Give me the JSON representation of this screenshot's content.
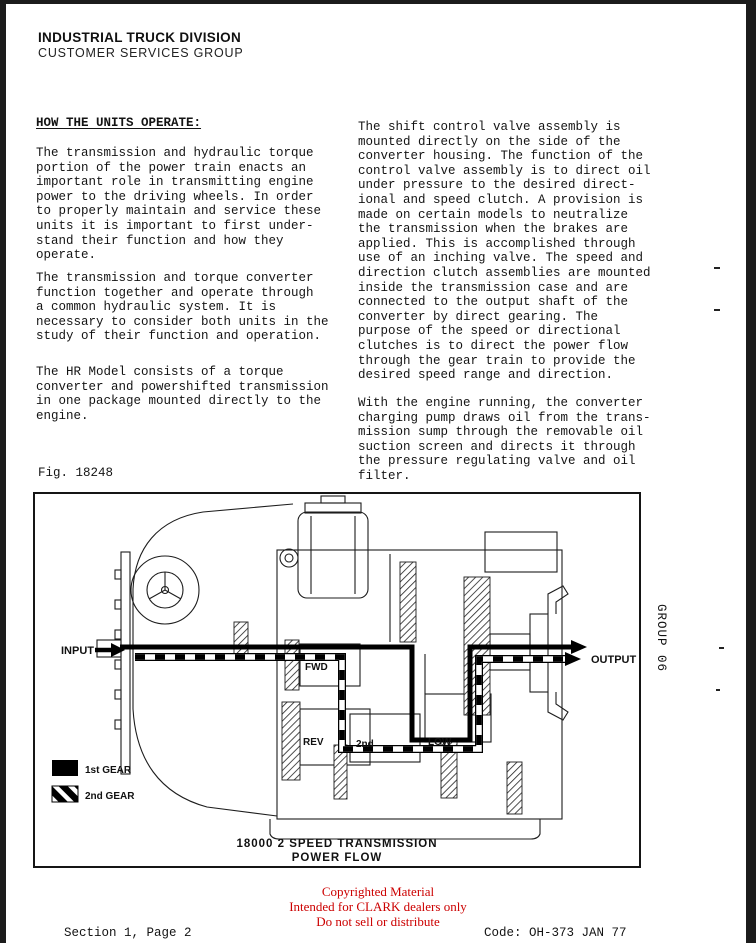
{
  "header": {
    "line1": "INDUSTRIAL TRUCK DIVISION",
    "line2": "CUSTOMER SERVICES GROUP"
  },
  "left_column": {
    "heading": "HOW THE UNITS OPERATE:",
    "p1": "The transmission and hydraulic torque\nportion of the power train enacts an\nimportant role in transmitting engine\npower to the driving wheels.  In order\nto properly maintain and service these\nunits it is important to first under-\nstand their function and how they\noperate.",
    "p2": "The transmission and torque converter\nfunction together and operate through\na common hydraulic system.  It is\nnecessary to consider both units in the\nstudy of their function and operation.",
    "p3": "The HR Model consists of a torque\nconverter and powershifted transmission\nin one package mounted directly to the\nengine.",
    "fig_label": "Fig. 18248"
  },
  "right_column": {
    "p1": "The shift control valve assembly is\nmounted directly on the side of the\nconverter housing.  The function of the\ncontrol valve assembly is to direct oil\nunder pressure to the desired direct-\nional and speed clutch.  A provision is\nmade on certain models to neutralize\nthe transmission when the brakes are\napplied.  This is accomplished through\nuse of an inching valve.  The speed and\ndirection clutch assemblies are mounted\ninside the transmission case and are\nconnected to the output shaft of the\nconverter by direct gearing.  The\npurpose of the speed or directional\nclutches is to direct the power flow\nthrough the gear train to provide the\ndesired speed range and direction.",
    "p2": "With the engine running, the converter\ncharging pump draws oil from the trans-\nmission sump through the removable oil\nsuction screen and directs it through\nthe pressure regulating valve and oil\nfilter."
  },
  "figure": {
    "labels": {
      "input": "INPUT",
      "output": "OUTPUT",
      "fwd": "FWD",
      "rev": "REV",
      "second": "2nd",
      "low": "LOW"
    },
    "legend": {
      "first_gear": "1st GEAR",
      "second_gear": "2nd GEAR"
    },
    "caption_line1": "18000 2 SPEED TRANSMISSION",
    "caption_line2": "POWER FLOW"
  },
  "sidebar": {
    "group_label": "GROUP 06"
  },
  "footer": {
    "notice": {
      "0": "Copyrighted Material",
      "1": "Intended for CLARK dealers only",
      "2": "Do not sell or distribute"
    },
    "notice_color": "#cc0000",
    "section": "Section 1, Page 2",
    "code": "Code: OH-373  JAN 77"
  }
}
